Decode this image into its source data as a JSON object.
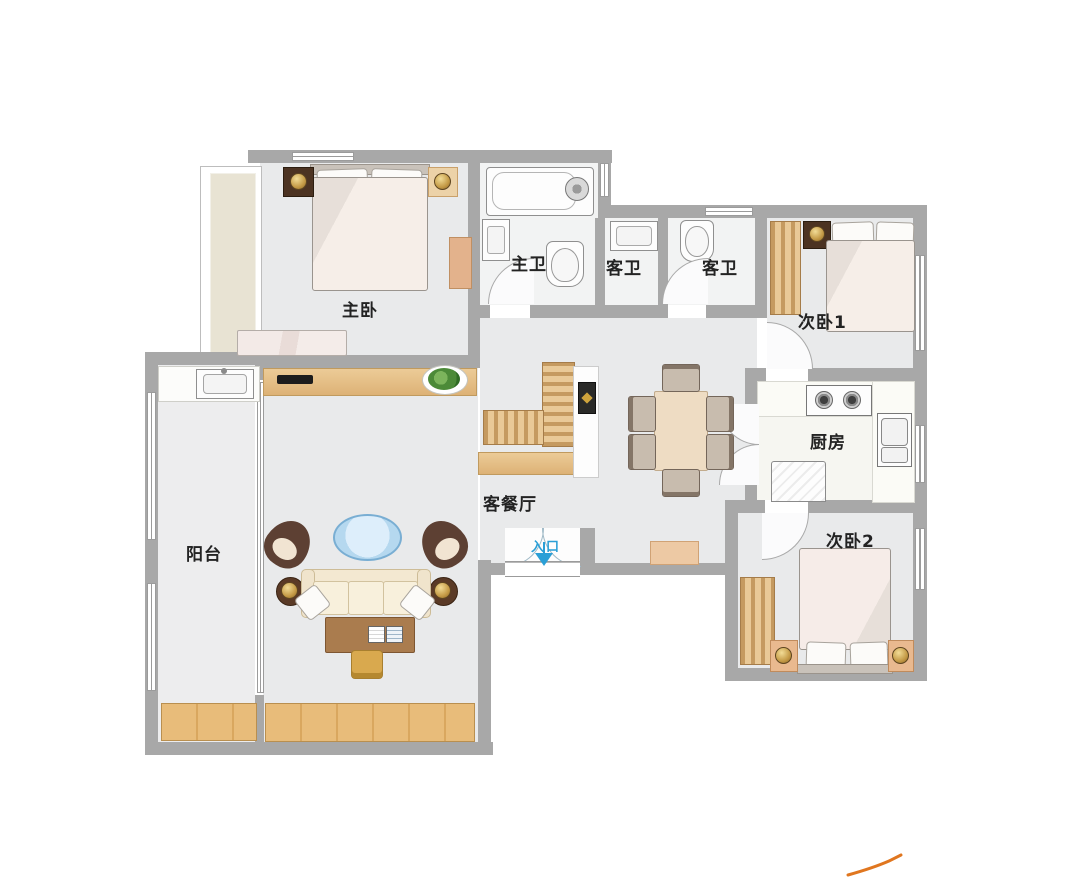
{
  "plan_title": "apartment-floor-plan",
  "rooms": {
    "master_bedroom": {
      "label": "主卧"
    },
    "master_bathroom": {
      "label": "主卫"
    },
    "guest_bathroom_a": {
      "label": "客卫"
    },
    "guest_bathroom_b": {
      "label": "客卫"
    },
    "bedroom_1": {
      "label": "次卧1"
    },
    "kitchen": {
      "label": "厨房"
    },
    "bedroom_2": {
      "label": "次卧2"
    },
    "living_dining": {
      "label": "客餐厅"
    },
    "balcony": {
      "label": "阳台"
    }
  },
  "entrance": {
    "label": "入口"
  },
  "colors": {
    "wall": "#a8a8a8",
    "floor": "#e9eaeb",
    "bath_floor": "#f2f3f3",
    "wood": "#e5c18c",
    "bed_linen": "#f4ebe5",
    "dark_furniture": "#4c3322",
    "entrance_blue": "#2b9fd6",
    "logo_orange": "#e0761f"
  }
}
